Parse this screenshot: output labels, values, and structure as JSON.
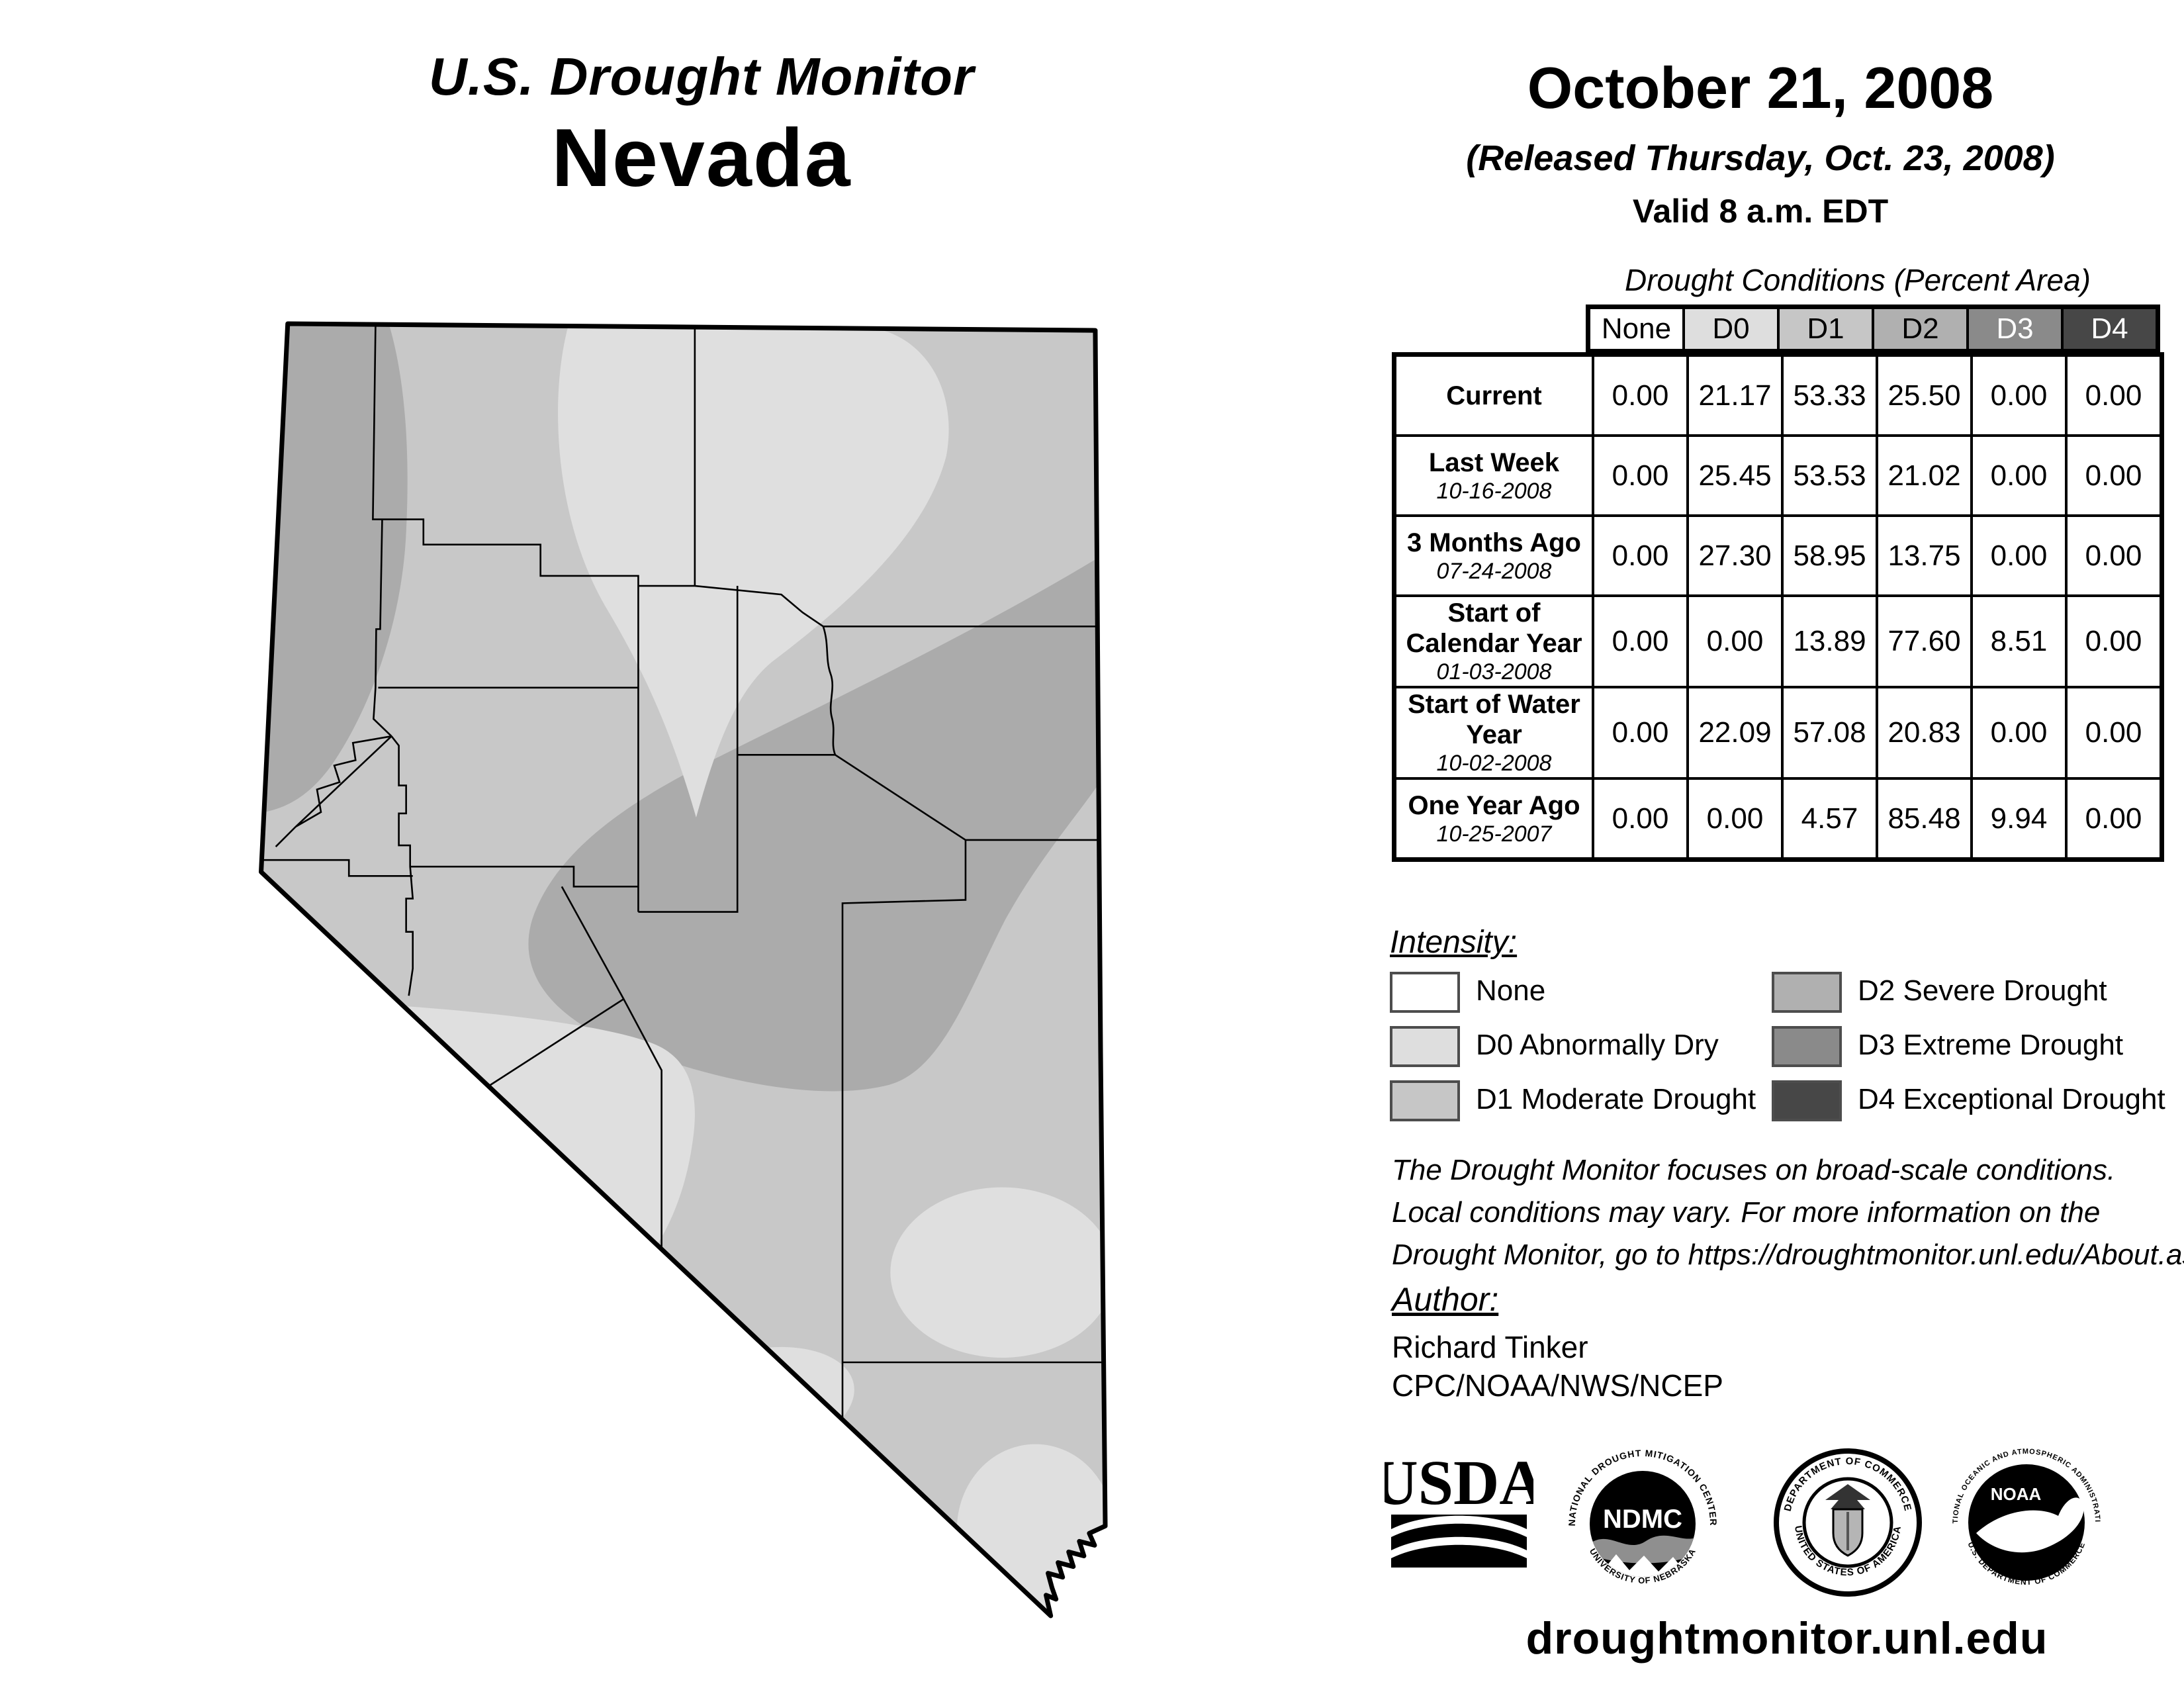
{
  "header": {
    "title_line1": "U.S. Drought Monitor",
    "title_line2": "Nevada",
    "date": "October 21, 2008",
    "released": "(Released Thursday, Oct. 23, 2008)",
    "valid": "Valid 8 a.m. EDT"
  },
  "table": {
    "caption": "Drought Conditions (Percent Area)",
    "columns": [
      "None",
      "D0",
      "D1",
      "D2",
      "D3",
      "D4"
    ],
    "column_colors": [
      "#ffffff",
      "#dedede",
      "#c6c6c6",
      "#b0b0b0",
      "#8a8a8a",
      "#474747"
    ],
    "column_text_colors": [
      "#000000",
      "#000000",
      "#000000",
      "#000000",
      "#ffffff",
      "#ffffff"
    ],
    "rows": [
      {
        "label": "Current",
        "date": "",
        "values": [
          "0.00",
          "21.17",
          "53.33",
          "25.50",
          "0.00",
          "0.00"
        ]
      },
      {
        "label": "Last Week",
        "date": "10-16-2008",
        "values": [
          "0.00",
          "25.45",
          "53.53",
          "21.02",
          "0.00",
          "0.00"
        ]
      },
      {
        "label": "3 Months Ago",
        "date": "07-24-2008",
        "values": [
          "0.00",
          "27.30",
          "58.95",
          "13.75",
          "0.00",
          "0.00"
        ]
      },
      {
        "label": "Start of Calendar Year",
        "date": "01-03-2008",
        "values": [
          "0.00",
          "0.00",
          "13.89",
          "77.60",
          "8.51",
          "0.00"
        ]
      },
      {
        "label": "Start of Water Year",
        "date": "10-02-2008",
        "values": [
          "0.00",
          "22.09",
          "57.08",
          "20.83",
          "0.00",
          "0.00"
        ]
      },
      {
        "label": "One Year Ago",
        "date": "10-25-2007",
        "values": [
          "0.00",
          "0.00",
          "4.57",
          "85.48",
          "9.94",
          "0.00"
        ]
      }
    ]
  },
  "legend": {
    "heading": "Intensity:",
    "items": [
      {
        "label": "None",
        "color": "#ffffff"
      },
      {
        "label": "D0 Abnormally Dry",
        "color": "#dedede"
      },
      {
        "label": "D1 Moderate Drought",
        "color": "#c6c6c6"
      },
      {
        "label": "D2 Severe Drought",
        "color": "#b0b0b0"
      },
      {
        "label": "D3 Extreme Drought",
        "color": "#8a8a8a"
      },
      {
        "label": "D4 Exceptional Drought",
        "color": "#474747"
      }
    ]
  },
  "disclaimer": {
    "lines": [
      "The Drought Monitor focuses on broad-scale conditions.",
      "Local conditions may vary. For more information on the",
      "Drought Monitor, go to https://droughtmonitor.unl.edu/About.aspx"
    ]
  },
  "author": {
    "heading": "Author:",
    "name": "Richard Tinker",
    "org": "CPC/NOAA/NWS/NCEP"
  },
  "logos": {
    "usda": {
      "text": "USDA"
    },
    "ndmc": {
      "top": "NATIONAL DROUGHT MITIGATION CENTER",
      "center": "NDMC",
      "bottom": "UNIVERSITY OF NEBRASKA"
    },
    "doc": {
      "top": "DEPARTMENT OF COMMERCE",
      "bottom": "UNITED STATES OF AMERICA"
    },
    "noaa": {
      "top": "NATIONAL OCEANIC AND ATMOSPHERIC ADMINISTRATION",
      "center": "NOAA",
      "bottom": "U.S. DEPARTMENT OF COMMERCE"
    }
  },
  "footer": {
    "url": "droughtmonitor.unl.edu"
  },
  "map": {
    "state": "Nevada",
    "fill_none": "#ffffff",
    "fill_d0": "#dfdfdf",
    "fill_d1": "#c8c8c8",
    "fill_d2": "#ababab"
  }
}
